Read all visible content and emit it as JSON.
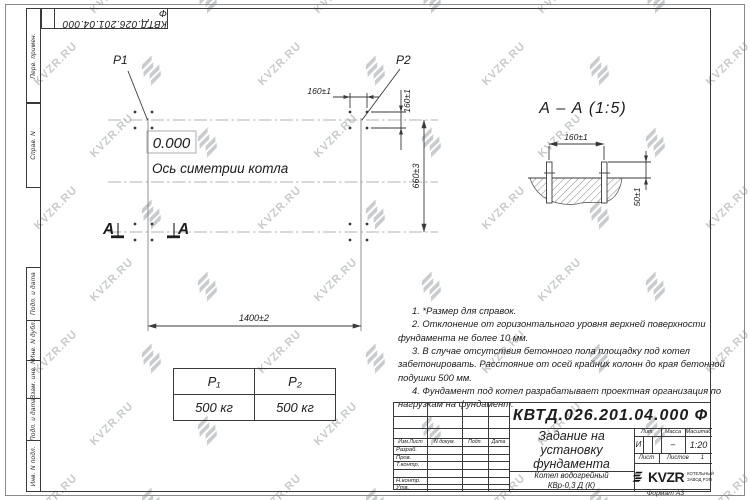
{
  "sheet": {
    "top_stamp": "КВТД.026.201.04.000  Ф",
    "format_label": "Формат А3"
  },
  "watermark": {
    "text": "KVZR.RU"
  },
  "side_labels": [
    "Перв. примен.",
    "Справ. N",
    "Подп. и дата",
    "Инв. N дубл.",
    "Взам. инв. N",
    "Подп. и дата",
    "Инв. N подл."
  ],
  "plan": {
    "p1_label": "P1",
    "p2_label": "P2",
    "elevation": "0.000",
    "axis_label": "Ось симетрии котла",
    "section_letter": "A",
    "dim_width": "1400±2",
    "dim_height": "660±3",
    "dim_bolt_h": "160±1",
    "dim_bolt_v": "160±1"
  },
  "section": {
    "title": "А – А (1:5)",
    "dim_spacing": "160±1",
    "dim_height": "50±1"
  },
  "load_table": {
    "headers": [
      "P₁",
      "P₂"
    ],
    "values": [
      "500 кг",
      "500 кг"
    ]
  },
  "notes": [
    "1. *Размер для справок.",
    "2. Отклонение от горизонтального уровня верхней поверхности фундамента не более 10 мм.",
    "3. В случае отсутствия бетонного пола площадку под котел забетонировать. Расстояние от осей крайних колонн до края бетонной подушки 500 мм.",
    "4. Фундамент под котел разрабатывает проектная организация по нагрузкам на фундамент."
  ],
  "title_block": {
    "designation": "КВТД.026.201.04.000  Ф",
    "doc_title": "Задание на\nустановку\nфундамента",
    "product": "Котел водогрейный\nКВр-0,3 Д (К)",
    "col_headers": [
      "Изм.Лист",
      "N докум.",
      "Подп.",
      "Дата"
    ],
    "row_labels": [
      "Разраб.",
      "Пров.",
      "Т.контр.",
      "",
      "Н.контр.",
      "Утв."
    ],
    "lit_label": "Лит.",
    "lit_value": "И",
    "mass_label": "Масса",
    "mass_value": "–",
    "scale_label": "Масштаб",
    "scale_value": "1:20",
    "sheet_label": "Лист",
    "sheets_label": "Листов",
    "sheets_value": "1",
    "brand": "KVZR",
    "brand_sub": "КОТЕЛЬНЫЙ\nЗАВОД РЭП"
  }
}
